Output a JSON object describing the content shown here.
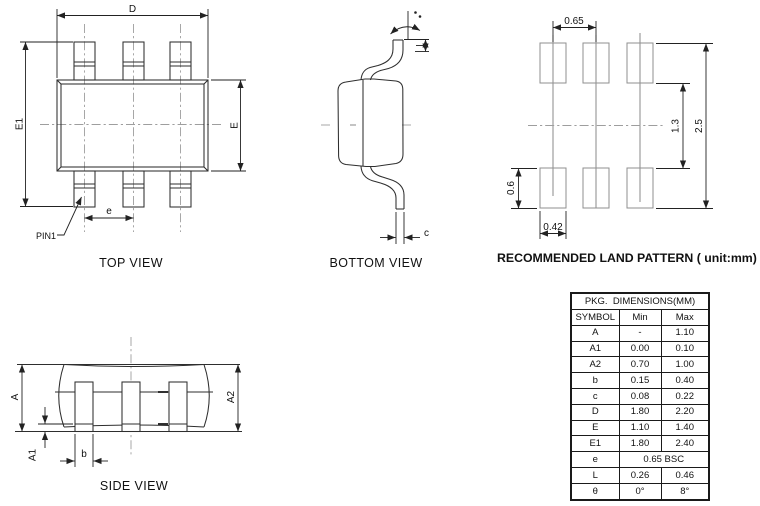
{
  "drawing": {
    "top_view": {
      "caption": "TOP VIEW",
      "dim_d": "D",
      "dim_e1": "E1",
      "dim_e": "E",
      "dim_pitch": "e",
      "pin1_label": "PIN1"
    },
    "bottom_view": {
      "caption": "BOTTOM VIEW",
      "dim_c": "c"
    },
    "land_pattern": {
      "caption": "RECOMMENDED LAND PATTERN ( unit:mm)",
      "dim_pitch": "0.65",
      "dim_inner_gap": "1.3",
      "dim_outer_span": "2.5",
      "dim_pad_height": "0.6",
      "dim_pad_width": "0.42"
    },
    "side_view": {
      "caption": "SIDE VIEW",
      "dim_a": "A",
      "dim_a1": "A1",
      "dim_a2": "A2",
      "dim_b": "b"
    }
  },
  "table": {
    "title": "PKG.  DIMENSIONS(MM)",
    "columns": [
      "SYMBOL",
      "Min",
      "Max"
    ],
    "rows": [
      {
        "symbol": "A",
        "min": "-",
        "max": "1.10"
      },
      {
        "symbol": "A1",
        "min": "0.00",
        "max": "0.10"
      },
      {
        "symbol": "A2",
        "min": "0.70",
        "max": "1.00"
      },
      {
        "symbol": "b",
        "min": "0.15",
        "max": "0.40"
      },
      {
        "symbol": "c",
        "min": "0.08",
        "max": "0.22"
      },
      {
        "symbol": "D",
        "min": "1.80",
        "max": "2.20"
      },
      {
        "symbol": "E",
        "min": "1.10",
        "max": "1.40"
      },
      {
        "symbol": "E1",
        "min": "1.80",
        "max": "2.40"
      },
      {
        "symbol": "e",
        "span": "0.65 BSC"
      },
      {
        "symbol": "L",
        "min": "0.26",
        "max": "0.46"
      },
      {
        "symbol": "θ",
        "min": "0°",
        "max": "8°"
      }
    ]
  },
  "colors": {
    "line": "#2e2e2e",
    "centerline": "#9e9e9e",
    "pad_outline": "#8f8f8f",
    "text": "#111111",
    "background": "#ffffff"
  }
}
